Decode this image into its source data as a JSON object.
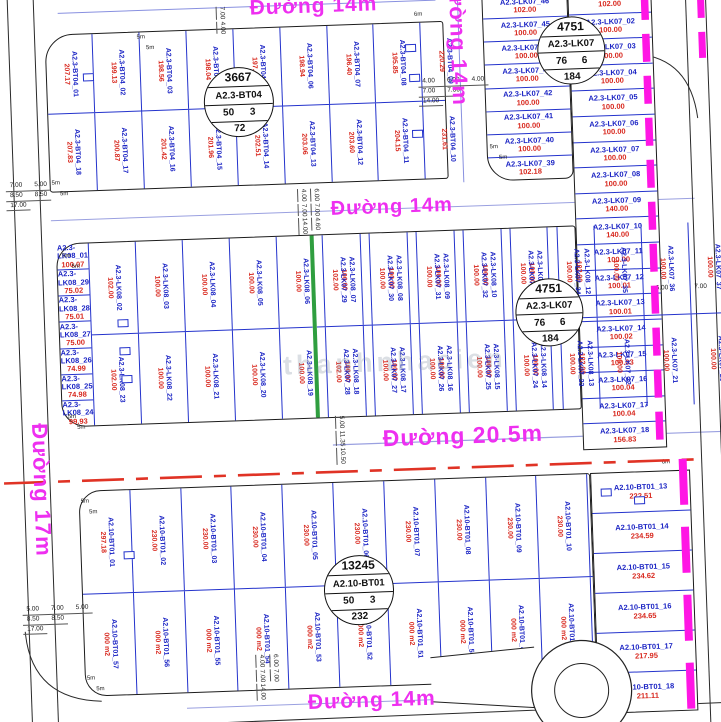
{
  "roads": {
    "top": "Đường 14m",
    "vertical": "Đường 14m",
    "middle": "Đường 14m",
    "boulevard": "Đường 20.5m",
    "left": "Đường 17m",
    "bottom": "Đường 14m"
  },
  "badges": [
    {
      "n": "3667",
      "block": "A2.3-BT04",
      "l": "50",
      "r": "3",
      "b": "72"
    },
    {
      "n": "4751",
      "block": "A2.3-LK07",
      "l": "76",
      "r": "6",
      "b": "184"
    },
    {
      "n": "4751",
      "block": "A2.3-LK07",
      "l": "76",
      "r": "6",
      "b": "184"
    },
    {
      "n": "13245",
      "block": "A2.10-BT01",
      "l": "50",
      "r": "3",
      "b": "232"
    }
  ],
  "blocks": {
    "bt04_top": [
      {
        "id": "A2.3-BT04_01",
        "area": "207.17"
      },
      {
        "id": "A2.3-BT04_02",
        "area": "199.13"
      },
      {
        "id": "A2.3-BT04_03",
        "area": "198.56"
      },
      {
        "id": "A2.3-BT04_04",
        "area": "198.04"
      },
      {
        "id": "A2.3-BT04_05",
        "area": "197.49"
      },
      {
        "id": "A2.3-BT04_06",
        "area": "198.94"
      },
      {
        "id": "A2.3-BT04_07",
        "area": "196.40"
      },
      {
        "id": "A2.3-BT04_08",
        "area": "195.85"
      },
      {
        "id": "A2.3-BT04_09",
        "area": "220.29"
      }
    ],
    "bt04_bottom": [
      {
        "id": "A2.3-BT04_18",
        "area": "207.83"
      },
      {
        "id": "A2.3-BT04_17",
        "area": "200.87"
      },
      {
        "id": "A2.3-BT04_16",
        "area": "201.42"
      },
      {
        "id": "A2.3-BT04_15",
        "area": "201.96"
      },
      {
        "id": "A2.3-BT04_14",
        "area": "202.51"
      },
      {
        "id": "A2.3-BT04_13",
        "area": "203.06"
      },
      {
        "id": "A2.3-BT04_12",
        "area": "203.60"
      },
      {
        "id": "A2.3-BT04_11",
        "area": "204.15"
      },
      {
        "id": "A2.3-BT04_10",
        "area": "231.61"
      }
    ],
    "lk08_left": [
      {
        "id": "A2.3-LK08_01",
        "area": "100.07"
      },
      {
        "id": "A2.3-LK08_29",
        "area": "75.02"
      },
      {
        "id": "A2.3-LK08_28",
        "area": "75.01"
      },
      {
        "id": "A2.3-LK08_27",
        "area": "75.00"
      },
      {
        "id": "A2.3-LK08_26",
        "area": "74.99"
      },
      {
        "id": "A2.3-LK08_25",
        "area": "74.98"
      },
      {
        "id": "A2.3-LK08_24",
        "area": "99.93"
      }
    ],
    "lk08_top": [
      {
        "id": "A2.3-LK08_02",
        "area": "102.00"
      },
      {
        "id": "A2.3-LK08_03",
        "area": "100.00"
      },
      {
        "id": "A2.3-LK08_04",
        "area": "100.00"
      },
      {
        "id": "A2.3-LK08_05",
        "area": "100.00"
      },
      {
        "id": "A2.3-LK08_06",
        "area": "100.00"
      },
      {
        "id": "A2.3-LK08_07",
        "area": "100.00"
      },
      {
        "id": "A2.3-LK08_08",
        "area": "100.00"
      },
      {
        "id": "A2.3-LK08_09",
        "area": "100.00"
      },
      {
        "id": "A2.3-LK08_10",
        "area": "100.00"
      },
      {
        "id": "A2.3-LK08_11",
        "area": "100.00"
      },
      {
        "id": "A2.3-LK08_12",
        "area": "102.00"
      }
    ],
    "lk08_bottom": [
      {
        "id": "A2.3-LK08_23",
        "area": "102.00"
      },
      {
        "id": "A2.3-LK08_22",
        "area": "100.00"
      },
      {
        "id": "A2.3-LK08_21",
        "area": "100.00"
      },
      {
        "id": "A2.3-LK08_20",
        "area": "100.00"
      },
      {
        "id": "A2.3-LK08_19",
        "area": "100.00"
      },
      {
        "id": "A2.3-LK08_18",
        "area": "100.00"
      },
      {
        "id": "A2.3-LK08_17",
        "area": "100.00"
      },
      {
        "id": "A2.3-LK08_16",
        "area": "100.00"
      },
      {
        "id": "A2.3-LK08_15",
        "area": "100.00"
      },
      {
        "id": "A2.3-LK08_14",
        "area": "100.00"
      },
      {
        "id": "A2.3-LK08_13",
        "area": "102.00"
      }
    ],
    "lk07_top": [
      {
        "id": "A2.3-LK07_29",
        "area": "102.00"
      },
      {
        "id": "A2.3-LK07_30",
        "area": "100.00"
      },
      {
        "id": "A2.3-LK07_31",
        "area": "100.00"
      },
      {
        "id": "A2.3-LK07_32",
        "area": "100.00"
      },
      {
        "id": "A2.3-LK07_33",
        "area": "100.00"
      },
      {
        "id": "A2.3-LK07_34",
        "area": "100.00"
      },
      {
        "id": "A2.3-LK07_35",
        "area": "100.00"
      },
      {
        "id": "A2.3-LK07_36",
        "area": "100.00"
      },
      {
        "id": "A2.3-LK07_37",
        "area": "100.00"
      },
      {
        "id": "A2.3-LK07_38",
        "area": "102.00"
      }
    ],
    "lk07_bottom": [
      {
        "id": "A2.3-LK07_28",
        "area": "102.00"
      },
      {
        "id": "A2.3-LK07_27",
        "area": "100.00"
      },
      {
        "id": "A2.3-LK07_26",
        "area": "100.00"
      },
      {
        "id": "A2.3-LK07_25",
        "area": "100.00"
      },
      {
        "id": "A2.3-LK07_24",
        "area": "100.00"
      },
      {
        "id": "A2.3-LK07_23",
        "area": "100.00"
      },
      {
        "id": "A2.3-LK07_22",
        "area": "100.00"
      },
      {
        "id": "A2.3-LK07_21",
        "area": "100.00"
      },
      {
        "id": "A2.3-LK07_20",
        "area": "100.00"
      },
      {
        "id": "A2.3-LK07_19",
        "area": "102.00"
      }
    ],
    "lk07_left": [
      {
        "id": "A2.3-LK07_46",
        "area": "102.00"
      },
      {
        "id": "A2.3-LK07_45",
        "area": "100.00"
      },
      {
        "id": "A2.3-LK07_44",
        "area": "100.00"
      },
      {
        "id": "A2.3-LK07_43",
        "area": "100.00"
      },
      {
        "id": "A2.3-LK07_42",
        "area": "100.00"
      },
      {
        "id": "A2.3-LK07_41",
        "area": "100.00"
      },
      {
        "id": "A2.3-LK07_40",
        "area": "100.00"
      },
      {
        "id": "A2.3-LK07_39",
        "area": "102.18"
      }
    ],
    "lk07_right": [
      {
        "id": "A2.3-LK07_01",
        "area": "102.00"
      },
      {
        "id": "A2.3-LK07_02",
        "area": "100.00"
      },
      {
        "id": "A2.3-LK07_03",
        "area": "100.00"
      },
      {
        "id": "A2.3-LK07_04",
        "area": "100.00"
      },
      {
        "id": "A2.3-LK07_05",
        "area": "100.00"
      },
      {
        "id": "A2.3-LK07_06",
        "area": "100.00"
      },
      {
        "id": "A2.3-LK07_07",
        "area": "100.00"
      },
      {
        "id": "A2.3-LK07_08",
        "area": "100.00"
      },
      {
        "id": "A2.3-LK07_09",
        "area": "140.00"
      },
      {
        "id": "A2.3-LK07_10",
        "area": "140.00"
      },
      {
        "id": "A2.3-LK07_11",
        "area": "100.00"
      },
      {
        "id": "A2.3-LK07_12",
        "area": "100.01"
      },
      {
        "id": "A2.3-LK07_13",
        "area": "100.01"
      },
      {
        "id": "A2.3-LK07_14",
        "area": "100.02"
      },
      {
        "id": "A2.3-LK07_15",
        "area": "100.03"
      },
      {
        "id": "A2.3-LK07_16",
        "area": "100.04"
      },
      {
        "id": "A2.3-LK07_17",
        "area": "100.04"
      },
      {
        "id": "A2.3-LK07_18",
        "area": "156.83"
      }
    ],
    "bt01_top": [
      {
        "id": "A2.10-BT01_01",
        "area": "297.18"
      },
      {
        "id": "A2.10-BT01_02",
        "area": "230.00"
      },
      {
        "id": "A2.10-BT01_03",
        "area": "230.00"
      },
      {
        "id": "A2.10-BT01_04",
        "area": "230.00"
      },
      {
        "id": "A2.10-BT01_05",
        "area": "230.00"
      },
      {
        "id": "A2.10-BT01_06",
        "area": "230.00"
      },
      {
        "id": "A2.10-BT01_07",
        "area": "230.00"
      },
      {
        "id": "A2.10-BT01_08",
        "area": "230.00"
      },
      {
        "id": "A2.10-BT01_09",
        "area": "230.00"
      },
      {
        "id": "A2.10-BT01_10",
        "area": "230.00"
      },
      {
        "id": "A2.10-BT01_11",
        "area": "230.00"
      },
      {
        "id": "A2.10-BT01_12",
        "area": "230.00"
      }
    ],
    "bt01_bottom": [
      {
        "id": "A2.10-BT01_57",
        "area": "000 m2"
      },
      {
        "id": "A2.10-BT01_56",
        "area": "000 m2"
      },
      {
        "id": "A2.10-BT01_55",
        "area": "000 m2"
      },
      {
        "id": "A2.10-BT01_54",
        "area": "000 m2"
      },
      {
        "id": "A2.10-BT01_53",
        "area": "000 m2"
      },
      {
        "id": "A2.10-BT01_52",
        "area": "000 m2"
      },
      {
        "id": "A2.10-BT01_51",
        "area": "000 m2"
      },
      {
        "id": "A2.10-BT01_50",
        "area": "000 m2"
      },
      {
        "id": "A2.10-BT01_49",
        "area": "000 m2"
      },
      {
        "id": "A2.10-BT01_48",
        "area": "000 m2"
      },
      {
        "id": "A2.10-BT01_47",
        "area": "000 m2"
      },
      {
        "id": "A2.10-BT01_46",
        "area": "000 m2"
      }
    ],
    "bt01_right": [
      {
        "id": "A2.10-BT01_13",
        "area": "222.51"
      },
      {
        "id": "A2.10-BT01_14",
        "area": "234.59"
      },
      {
        "id": "A2.10-BT01_15",
        "area": "234.62"
      },
      {
        "id": "A2.10-BT01_16",
        "area": "234.65"
      },
      {
        "id": "A2.10-BT01_17",
        "area": "217.95"
      },
      {
        "id": "A2.10-BT01_18",
        "area": "211.11"
      }
    ]
  },
  "dims": {
    "left_top": [
      "7.00",
      "5.00",
      "8.50",
      "8.50",
      "17.00"
    ],
    "left_bottom": [
      "5.00",
      "7.00",
      "5.00",
      "8.50",
      "8.50",
      "17.00"
    ],
    "right_top": [
      "4.00",
      "6.00",
      "4.00",
      "7.00",
      "7.00",
      "14.00"
    ],
    "mid_road": [
      "4.00",
      "7.00",
      "14.00",
      "6.00",
      "7.00",
      "4.60"
    ],
    "right_mid": [
      "6.00",
      "7.00"
    ],
    "road205": [
      "5.00",
      "11.35",
      "10.50"
    ],
    "bottom_road": [
      "4.00",
      "7.00",
      "14.00",
      "6.00",
      "7.00"
    ],
    "top_mid": [
      "7.00",
      "4.00"
    ],
    "corner_5m": "5m",
    "corner_6m": "6m"
  },
  "colors": {
    "plot_line": "#2433cc",
    "plot_id_text": "#1b24c4",
    "area_text": "#d8281e",
    "road_label": "#ee2ff0",
    "boundary_magenta": "#ff16e4",
    "red_planning_line": "#e03325",
    "green_plot": "#2f9e3f"
  },
  "watermark": "thanhnhacien"
}
